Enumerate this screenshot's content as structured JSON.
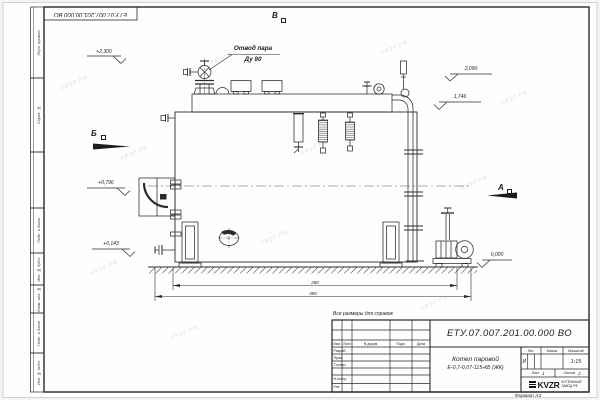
{
  "sheet": {
    "top_stamp": "ЕТУ.07.007.201.00.000 ВО",
    "format_label": "Формат А3",
    "watermark": "КВЗР.РФ",
    "margin_labels": [
      "Перв. примен.",
      "Справ. №",
      "",
      "Подп. и дата",
      "Инв. № дубл.",
      "Взам. инв. №",
      "Подп. и дата",
      "Инв. № подл."
    ]
  },
  "drawing": {
    "callout_line1": "Отвод пара",
    "callout_line2": "Ду 80",
    "view_top": "В",
    "view_left": "Б",
    "view_right": "А",
    "dim_upper": "280",
    "dim_lower": "390",
    "elevations": [
      "+2,300",
      "2,090",
      "1,746",
      "+0,796",
      "+0,143",
      "0,000"
    ]
  },
  "title_block": {
    "reference_note": "Все размеры для справок",
    "doc_number": "ЕТУ.07.007.201.00.000  ВО",
    "product_line1": "Котел паровой",
    "product_line2": "Е-0,7-0,07-115-КБ (ЖК)",
    "col_izm": "Изм.",
    "col_list": "Лист",
    "col_ndokum": "N докум.",
    "col_podp": "Подп.",
    "col_data": "Дата",
    "row_razrab": "Разраб.",
    "row_prov": "Пров.",
    "row_tkontr": "Т.контр.",
    "row_nkontr": "Н.контр.",
    "row_utv": "Утв.",
    "lit_label": "Лит.",
    "mass_label": "Масса",
    "scale_label": "Масштаб",
    "lit_value": "И",
    "scale_value": "1:15",
    "sheet_label": "Лист",
    "sheet_value": "1",
    "sheets_label": "Листов",
    "sheets_value": "2",
    "logo_text": "KVZR",
    "company_line1": "КОТЕЛЬНЫЙ",
    "company_line2": "ЗАВОД РФ"
  }
}
